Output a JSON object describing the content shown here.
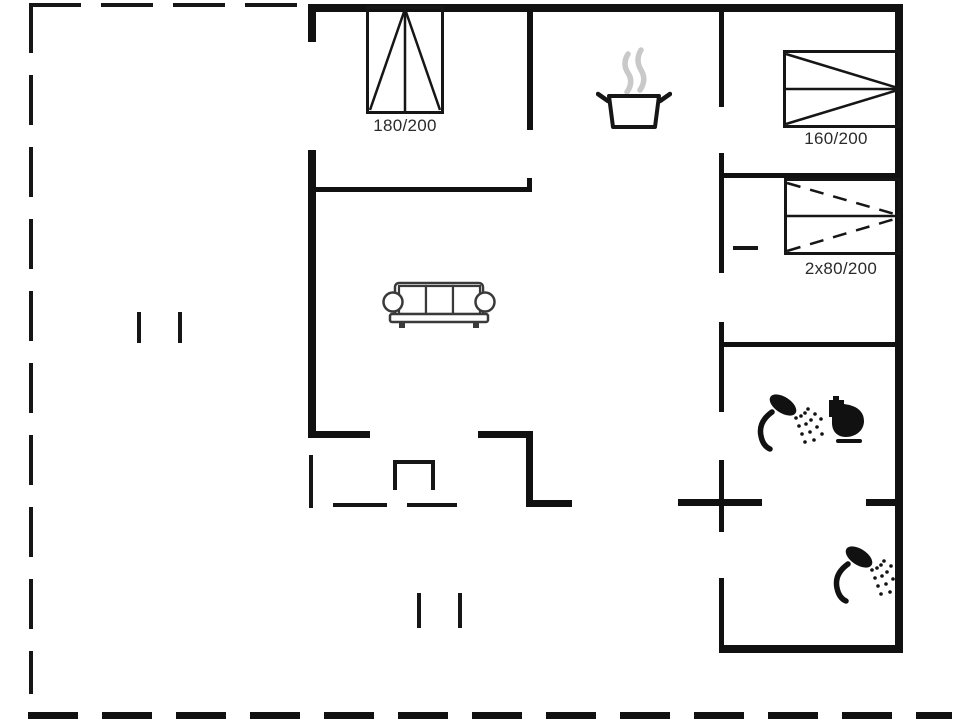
{
  "page": {
    "type": "holiday-home-floor-plan",
    "background": "#ffffff"
  },
  "colors": {
    "wall": "#111111",
    "text": "#2b2b2b",
    "steam": "#c9c9c9",
    "icon": "#111111"
  },
  "labels": {
    "bed_180": "180/200",
    "bed_160": "160/200",
    "bed_2x80": "2x80/200"
  },
  "icons": [
    {
      "name": "cooking-pot-icon",
      "meaning": "kitchen"
    },
    {
      "name": "sofa-icon",
      "meaning": "living room"
    },
    {
      "name": "shower-icon",
      "meaning": "bathroom shower"
    },
    {
      "name": "toilet-icon",
      "meaning": "bathroom toilet"
    },
    {
      "name": "shower-icon",
      "meaning": "second shower room"
    },
    {
      "name": "wood-stove-icon",
      "meaning": "stove against south wall"
    },
    {
      "name": "double-bed-symbol",
      "meaning": "bed 180/200"
    },
    {
      "name": "single-bed-symbol",
      "meaning": "bed 160/200"
    },
    {
      "name": "folding-bed-symbol",
      "meaning": "beds 2x80/200"
    },
    {
      "name": "terrace-dashed-boundary",
      "meaning": "terrace / deck outline"
    }
  ]
}
